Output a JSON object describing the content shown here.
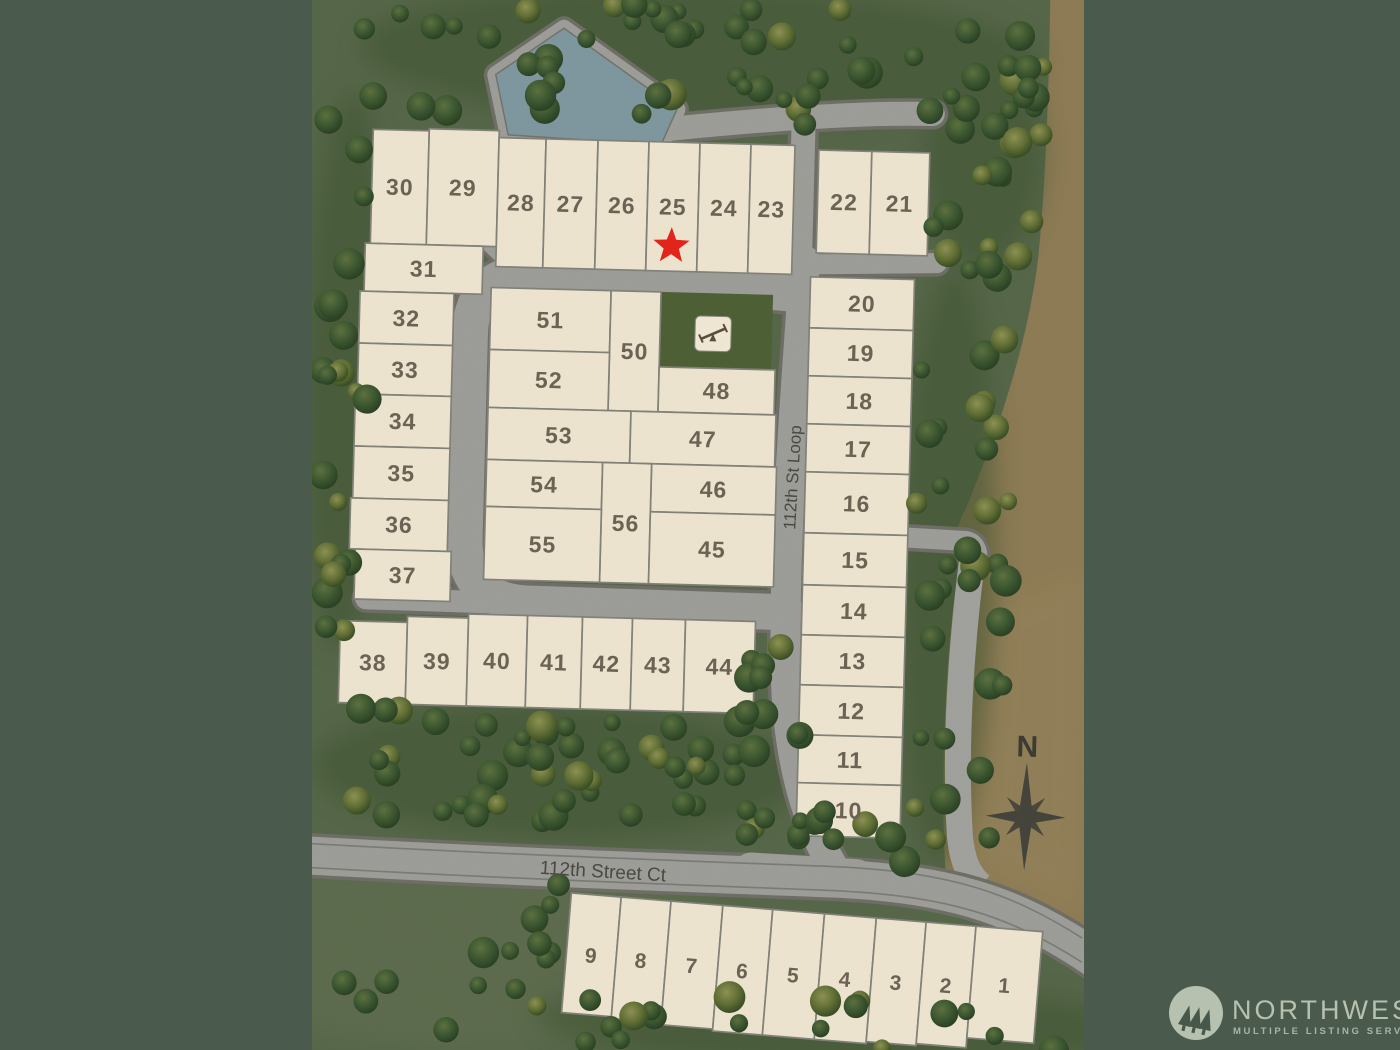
{
  "map": {
    "streets": [
      {
        "id": "loop",
        "name": "112th St Loop"
      },
      {
        "id": "ct",
        "name": "112th Street Ct"
      }
    ],
    "compass": {
      "label": "N"
    },
    "marker": {
      "shape": "star",
      "lot": "25",
      "color": "#e5251b"
    },
    "amenity": {
      "type": "playground",
      "icon": "seesaw-icon"
    },
    "colors": {
      "outer_band": "#4a5a4d",
      "grass": "#57684a",
      "forest": "#3f5531",
      "dirt": "#8e7c55",
      "lot_fill": "#efe6d2",
      "lot_stroke": "#83837a",
      "road_fill": "#9e9e9a",
      "road_edge": "#6f6f67",
      "pond": "#7f98a0",
      "star": "#e5251b",
      "compass": "#45453c",
      "logo": "#b7c1b0"
    },
    "lots_main": [
      {
        "n": "30",
        "x": 365,
        "y": 138,
        "w": 56,
        "h": 114
      },
      {
        "n": "29",
        "x": 421,
        "y": 136,
        "w": 70,
        "h": 116
      },
      {
        "n": "28",
        "x": 491,
        "y": 143,
        "w": 47,
        "h": 129
      },
      {
        "n": "27",
        "x": 538,
        "y": 143,
        "w": 52,
        "h": 129
      },
      {
        "n": "26",
        "x": 590,
        "y": 143,
        "w": 51,
        "h": 129
      },
      {
        "n": "25",
        "x": 641,
        "y": 143,
        "w": 51,
        "h": 129
      },
      {
        "n": "24",
        "x": 692,
        "y": 143,
        "w": 51,
        "h": 129
      },
      {
        "n": "23",
        "x": 743,
        "y": 143,
        "w": 44,
        "h": 129
      },
      {
        "n": "22",
        "x": 811,
        "y": 147,
        "w": 53,
        "h": 103
      },
      {
        "n": "21",
        "x": 864,
        "y": 147,
        "w": 58,
        "h": 103
      },
      {
        "n": "31",
        "x": 360,
        "y": 252,
        "w": 118,
        "h": 48
      },
      {
        "n": "32",
        "x": 356,
        "y": 300,
        "w": 94,
        "h": 52
      },
      {
        "n": "33",
        "x": 356,
        "y": 352,
        "w": 94,
        "h": 51
      },
      {
        "n": "34",
        "x": 354,
        "y": 403,
        "w": 96,
        "h": 52
      },
      {
        "n": "35",
        "x": 354,
        "y": 455,
        "w": 96,
        "h": 52
      },
      {
        "n": "36",
        "x": 352,
        "y": 507,
        "w": 98,
        "h": 51
      },
      {
        "n": "37",
        "x": 358,
        "y": 558,
        "w": 96,
        "h": 50
      },
      {
        "n": "51",
        "x": 487,
        "y": 293,
        "w": 120,
        "h": 62
      },
      {
        "n": "50",
        "x": 607,
        "y": 293,
        "w": 50,
        "h": 120
      },
      {
        "n": "52",
        "x": 487,
        "y": 355,
        "w": 120,
        "h": 58
      },
      {
        "n": "48",
        "x": 657,
        "y": 368,
        "w": 116,
        "h": 45
      },
      {
        "n": "53",
        "x": 487,
        "y": 413,
        "w": 143,
        "h": 52
      },
      {
        "n": "47",
        "x": 630,
        "y": 413,
        "w": 145,
        "h": 52
      },
      {
        "n": "54",
        "x": 487,
        "y": 465,
        "w": 116,
        "h": 47
      },
      {
        "n": "46",
        "x": 652,
        "y": 465,
        "w": 125,
        "h": 48
      },
      {
        "n": "56",
        "x": 603,
        "y": 465,
        "w": 49,
        "h": 120
      },
      {
        "n": "55",
        "x": 487,
        "y": 512,
        "w": 116,
        "h": 73
      },
      {
        "n": "45",
        "x": 652,
        "y": 513,
        "w": 125,
        "h": 72
      },
      {
        "n": "20",
        "x": 806,
        "y": 274,
        "w": 104,
        "h": 51
      },
      {
        "n": "19",
        "x": 806,
        "y": 325,
        "w": 104,
        "h": 48
      },
      {
        "n": "18",
        "x": 806,
        "y": 373,
        "w": 104,
        "h": 48
      },
      {
        "n": "17",
        "x": 806,
        "y": 421,
        "w": 104,
        "h": 48
      },
      {
        "n": "16",
        "x": 806,
        "y": 469,
        "w": 104,
        "h": 61
      },
      {
        "n": "15",
        "x": 806,
        "y": 530,
        "w": 104,
        "h": 52
      },
      {
        "n": "14",
        "x": 806,
        "y": 582,
        "w": 104,
        "h": 50
      },
      {
        "n": "13",
        "x": 806,
        "y": 632,
        "w": 104,
        "h": 50
      },
      {
        "n": "12",
        "x": 806,
        "y": 682,
        "w": 104,
        "h": 50
      },
      {
        "n": "11",
        "x": 806,
        "y": 732,
        "w": 104,
        "h": 48
      },
      {
        "n": "10",
        "x": 806,
        "y": 780,
        "w": 104,
        "h": 53
      },
      {
        "n": "38",
        "x": 345,
        "y": 630,
        "w": 67,
        "h": 82
      },
      {
        "n": "39",
        "x": 412,
        "y": 624,
        "w": 61,
        "h": 88
      },
      {
        "n": "40",
        "x": 473,
        "y": 620,
        "w": 59,
        "h": 92
      },
      {
        "n": "41",
        "x": 532,
        "y": 620,
        "w": 55,
        "h": 92
      },
      {
        "n": "42",
        "x": 587,
        "y": 620,
        "w": 50,
        "h": 92
      },
      {
        "n": "43",
        "x": 637,
        "y": 620,
        "w": 53,
        "h": 92
      },
      {
        "n": "44",
        "x": 690,
        "y": 620,
        "w": 70,
        "h": 92
      }
    ],
    "lots_strip": [
      {
        "n": "9",
        "x": 3,
        "y": 0,
        "w": 50,
        "h": 120
      },
      {
        "n": "8",
        "x": 53,
        "y": 0,
        "w": 50,
        "h": 122
      },
      {
        "n": "7",
        "x": 103,
        "y": 0,
        "w": 52,
        "h": 124
      },
      {
        "n": "6",
        "x": 155,
        "y": 0,
        "w": 50,
        "h": 126
      },
      {
        "n": "5",
        "x": 205,
        "y": 0,
        "w": 52,
        "h": 126
      },
      {
        "n": "4",
        "x": 257,
        "y": 0,
        "w": 52,
        "h": 126
      },
      {
        "n": "3",
        "x": 309,
        "y": 0,
        "w": 50,
        "h": 124
      },
      {
        "n": "2",
        "x": 359,
        "y": 0,
        "w": 50,
        "h": 122
      },
      {
        "n": "1",
        "x": 409,
        "y": 0,
        "w": 67,
        "h": 112
      }
    ]
  },
  "branding": {
    "name": "NORTHWEST",
    "tagline": "MULTIPLE LISTING SERVICE."
  }
}
